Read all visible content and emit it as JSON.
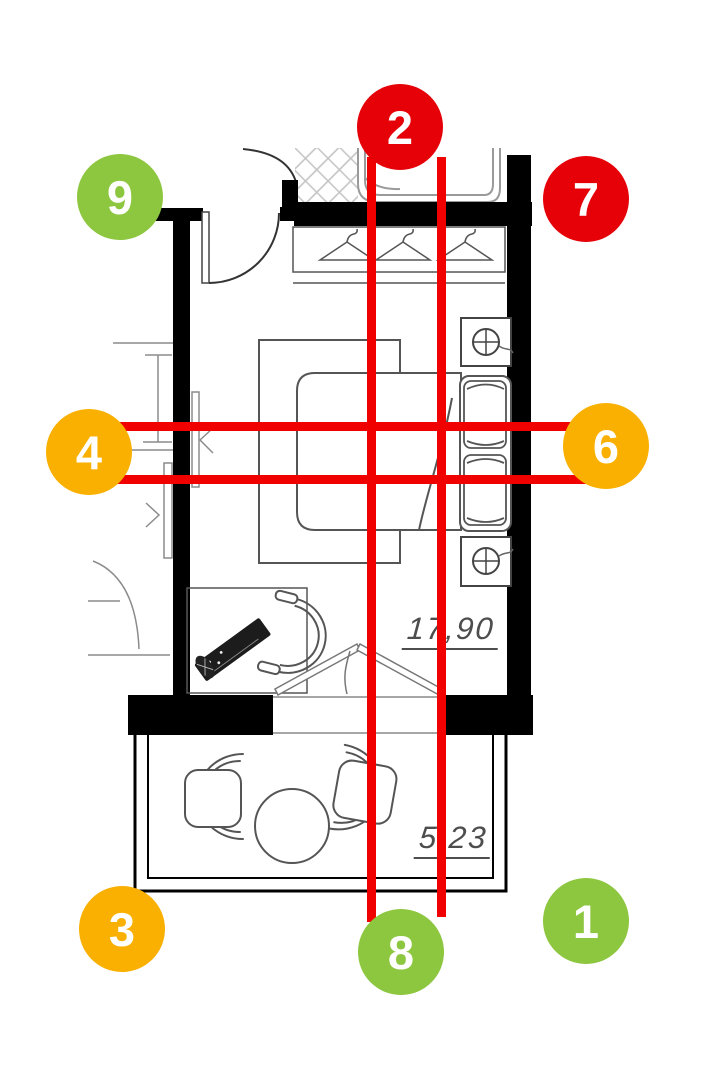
{
  "floor_plan": {
    "room_area_label": "17,90",
    "balcony_area_label": "5,23"
  },
  "annotations": {
    "marker_colors": {
      "green": "#8DC63F",
      "red": "#E60008",
      "amber": "#F9B000"
    },
    "line_color": "#F10000",
    "markers": [
      {
        "label": "1",
        "color_key": "green",
        "cx": 586,
        "cy": 921
      },
      {
        "label": "2",
        "color_key": "red",
        "cx": 400,
        "cy": 127
      },
      {
        "label": "3",
        "color_key": "amber",
        "cx": 122,
        "cy": 929
      },
      {
        "label": "4",
        "color_key": "amber",
        "cx": 89,
        "cy": 452
      },
      {
        "label": "6",
        "color_key": "amber",
        "cx": 606,
        "cy": 446
      },
      {
        "label": "7",
        "color_key": "red",
        "cx": 586,
        "cy": 199
      },
      {
        "label": "8",
        "color_key": "green",
        "cx": 401,
        "cy": 952
      },
      {
        "label": "9",
        "color_key": "green",
        "cx": 120,
        "cy": 197
      }
    ],
    "lines": [
      {
        "orientation": "vertical",
        "x": 367,
        "y1": 157,
        "y2": 922,
        "thickness": 9
      },
      {
        "orientation": "vertical",
        "x": 437,
        "y1": 157,
        "y2": 917,
        "thickness": 9
      },
      {
        "orientation": "horizontal",
        "y": 422,
        "x1": 100,
        "x2": 600,
        "thickness": 9
      },
      {
        "orientation": "horizontal",
        "y": 475,
        "x1": 100,
        "x2": 600,
        "thickness": 9
      }
    ]
  }
}
